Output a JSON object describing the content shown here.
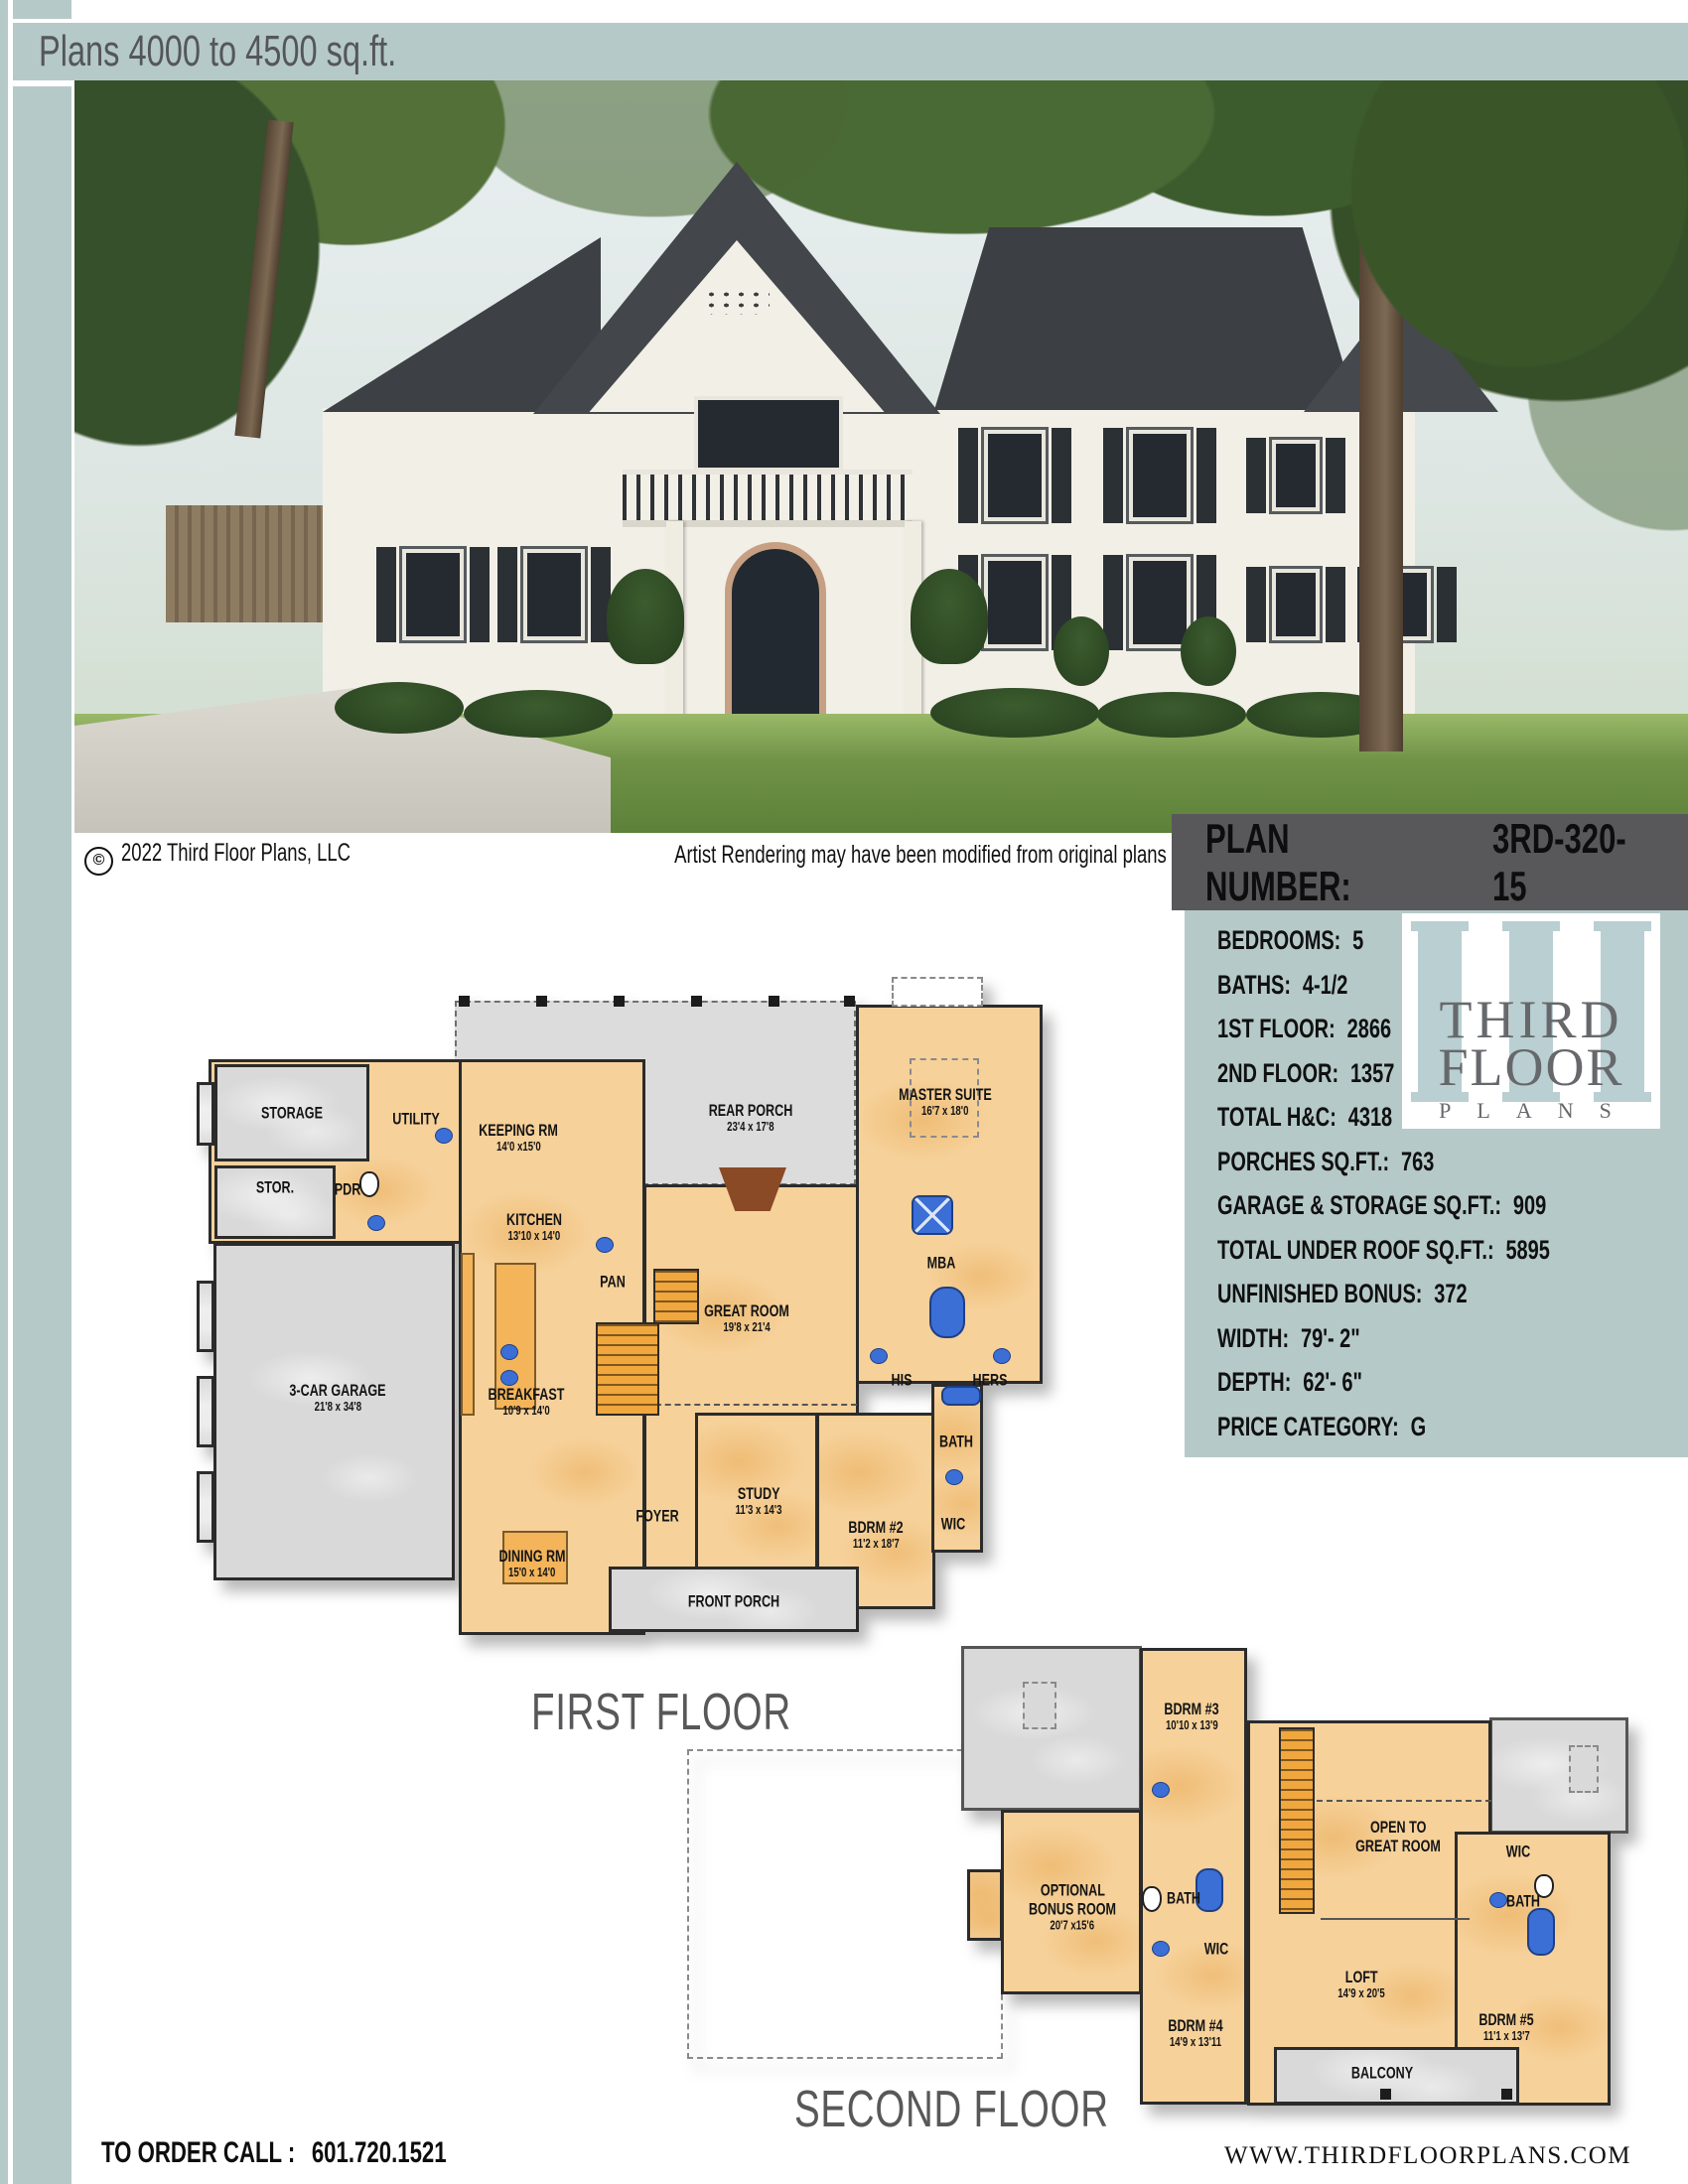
{
  "header": {
    "title": "Plans 4000 to 4500 sq.ft."
  },
  "photo": {
    "caption_symbol": "©",
    "caption_copyright": "2022 Third Floor Plans, LLC",
    "caption_note": "Artist Rendering may have been modified from original plans"
  },
  "plan_bar": {
    "label": "PLAN NUMBER:",
    "value": "3RD-320-15"
  },
  "info_panel": {
    "rows": [
      {
        "label": "BEDROOMS:",
        "value": "5"
      },
      {
        "label": "BATHS:",
        "value": "4-1/2"
      },
      {
        "label": "1ST FLOOR:",
        "value": "2866"
      },
      {
        "label": "2ND FLOOR:",
        "value": "1357"
      },
      {
        "label": "TOTAL H&C:",
        "value": "4318"
      },
      {
        "label": "PORCHES SQ.FT.:",
        "value": "763"
      },
      {
        "label": "GARAGE & STORAGE SQ.FT.:",
        "value": "909"
      },
      {
        "label": "TOTAL UNDER ROOF SQ.FT.:",
        "value": "5895"
      },
      {
        "label": "UNFINISHED BONUS:",
        "value": "372"
      },
      {
        "label": "WIDTH:",
        "value": "79'- 2\""
      },
      {
        "label": "DEPTH:",
        "value": "62'- 6\""
      },
      {
        "label": "PRICE CATEGORY:",
        "value": "G"
      }
    ]
  },
  "logo": {
    "monogram": "III",
    "line1": "THIRD",
    "line2": "FLOOR",
    "line3": "PLANS"
  },
  "first_floor": {
    "title": "FIRST FLOOR",
    "rooms": [
      {
        "name": "STORAGE",
        "dims": ""
      },
      {
        "name": "STOR.",
        "dims": ""
      },
      {
        "name": "UTILITY",
        "dims": ""
      },
      {
        "name": "PDR",
        "dims": ""
      },
      {
        "name": "KEEPING RM",
        "dims": "14'0 x15'0"
      },
      {
        "name": "REAR PORCH",
        "dims": "23'4 x 17'8"
      },
      {
        "name": "MASTER SUITE",
        "dims": "16'7 x 18'0"
      },
      {
        "name": "KITCHEN",
        "dims": "13'10 x 14'0"
      },
      {
        "name": "PAN",
        "dims": ""
      },
      {
        "name": "GREAT ROOM",
        "dims": "19'8 x 21'4"
      },
      {
        "name": "MBA",
        "dims": ""
      },
      {
        "name": "HIS",
        "dims": ""
      },
      {
        "name": "HERS",
        "dims": ""
      },
      {
        "name": "3-CAR GARAGE",
        "dims": "21'8 x 34'8"
      },
      {
        "name": "BREAKFAST",
        "dims": "10'9 x 14'0"
      },
      {
        "name": "DINING RM",
        "dims": "15'0 x 14'0"
      },
      {
        "name": "FOYER",
        "dims": ""
      },
      {
        "name": "STUDY",
        "dims": "11'3 x 14'3"
      },
      {
        "name": "BDRM #2",
        "dims": "11'2 x 18'7"
      },
      {
        "name": "BATH",
        "dims": ""
      },
      {
        "name": "WIC",
        "dims": ""
      },
      {
        "name": "FRONT PORCH",
        "dims": ""
      }
    ]
  },
  "second_floor": {
    "title": "SECOND FLOOR",
    "rooms": [
      {
        "name": "BDRM #3",
        "dims": "10'10 x 13'9"
      },
      {
        "name": "OPTIONAL",
        "name2": "BONUS ROOM",
        "dims": "20'7 x15'6"
      },
      {
        "name": "OPEN TO",
        "name2": "GREAT ROOM",
        "dims": ""
      },
      {
        "name": "BATH",
        "dims": ""
      },
      {
        "name": "WIC",
        "dims": ""
      },
      {
        "name": "LOFT",
        "dims": "14'9 x 20'5"
      },
      {
        "name": "BDRM #4",
        "dims": "14'9 x 13'11"
      },
      {
        "name": "BDRM #5",
        "dims": "11'1 x 13'7"
      },
      {
        "name": "WIC",
        "dims": ""
      },
      {
        "name": "BATH",
        "dims": ""
      },
      {
        "name": "BALCONY",
        "dims": ""
      }
    ]
  },
  "footer": {
    "order_label": "TO ORDER CALL :",
    "phone": "601.720.1521",
    "website": "WWW.THIRDFLOORPLANS.COM"
  },
  "colors": {
    "teal": "#b5c9c8",
    "bar_gray": "#58585b",
    "title_gray": "#58585a",
    "room_tan": "#f6d19a",
    "accent_orange": "#f0a73e",
    "gray_room": "#d9d9d9",
    "wall": "#2b2b2b",
    "fixture_blue": "#3b6fd6",
    "logo_teal": "#b9cfd2"
  }
}
